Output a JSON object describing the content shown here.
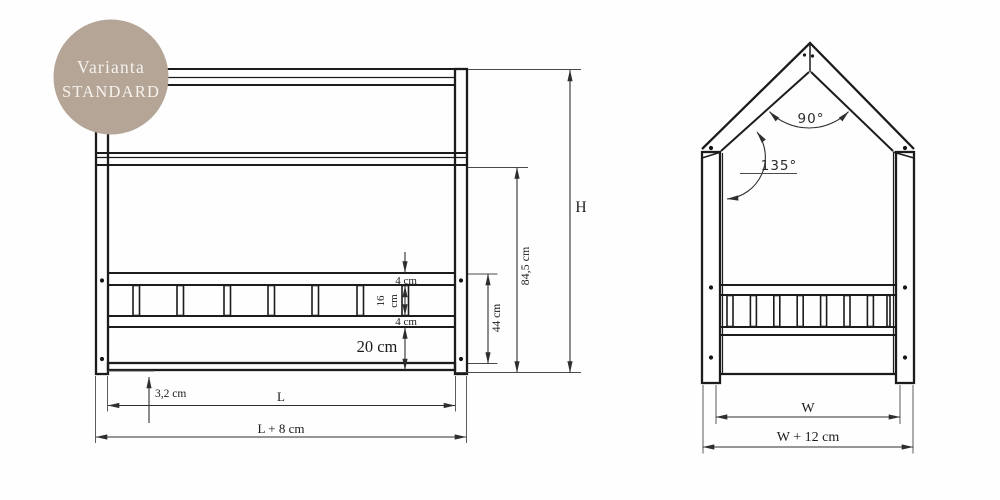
{
  "badge": {
    "line1": "Varianta",
    "line2": "STANDARD"
  },
  "front_view": {
    "labels": {
      "rail_top_thickness": "4 cm",
      "slat_height_num": "16",
      "slat_height_unit": "cm",
      "rail_bottom_thickness": "4 cm",
      "bottom_gap": "20 cm",
      "floor_clearance": "3,2 cm",
      "inner_length": "L",
      "outer_length": "L + 8 cm",
      "guard_height": "44 cm",
      "side_height": "84,5 cm",
      "total_height": "H"
    },
    "slat_count": 7
  },
  "side_view": {
    "labels": {
      "peak_angle": "90°",
      "eave_angle": "135°",
      "inner_width": "W",
      "outer_width": "W + 12 cm"
    },
    "slat_count": 7
  },
  "colors": {
    "badge_bg": "#b4a596",
    "badge_text": "#f6f2ed",
    "line": "#1c1c1c",
    "dim": "#2e2e2e"
  }
}
